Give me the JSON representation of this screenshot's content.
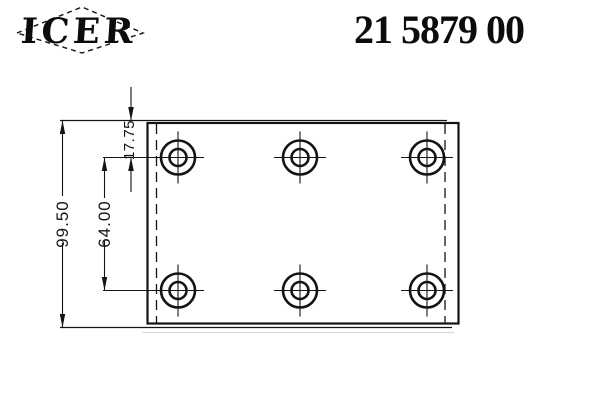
{
  "header": {
    "brand": "ICER",
    "part_number": "21 5879 00"
  },
  "drawing": {
    "dimension_labels": {
      "total_height": "99.50",
      "row_spacing": "64.00",
      "top_to_first_row": "17.75"
    },
    "hole_grid": {
      "rows": 2,
      "columns": 3,
      "count": 6
    },
    "geometry": {
      "hole_centers": [
        [
          178,
          157.5
        ],
        [
          300,
          157.5
        ],
        [
          427,
          157.5
        ],
        [
          178,
          290.5
        ],
        [
          300,
          290.5
        ],
        [
          427,
          290.5
        ]
      ],
      "hole_outer_radius": 17,
      "hole_inner_radius": 8.5,
      "crosshair_half_length": 26
    },
    "ink_color": "#141414"
  }
}
